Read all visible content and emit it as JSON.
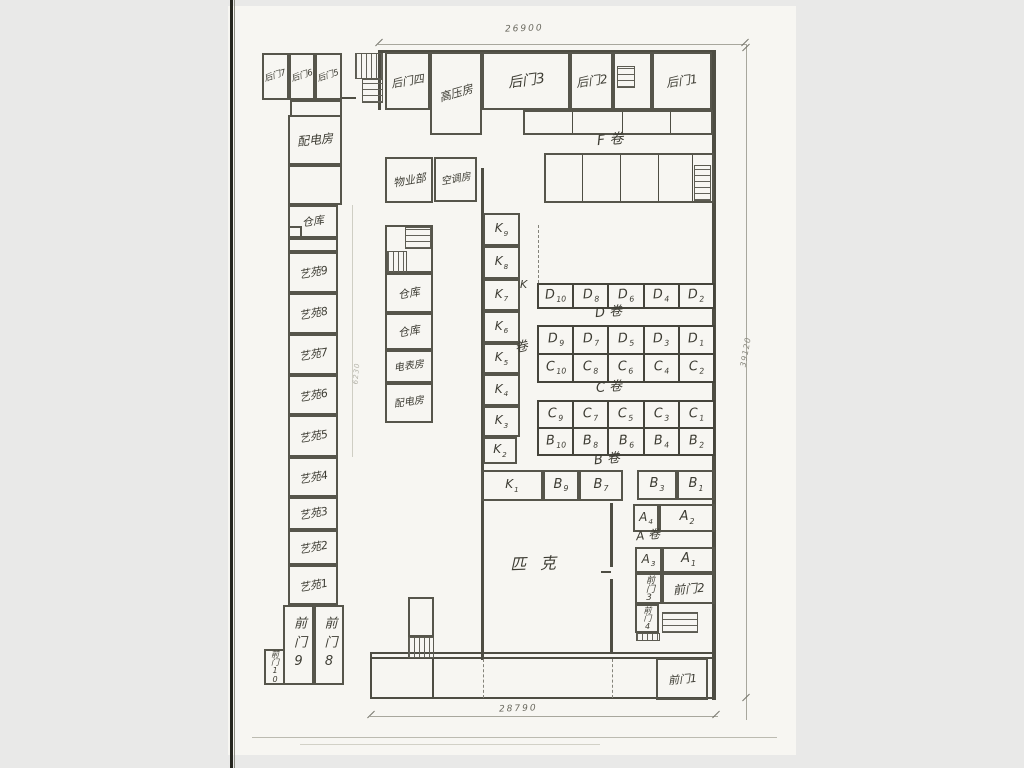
{
  "canvas": {
    "w": 1024,
    "h": 768,
    "bg": "#e9e9e8",
    "paper": "#f7f6f2",
    "ink": "#3d3c33",
    "wall": "#4e4d43"
  },
  "artifacts": [
    {
      "id": "paper-sheet",
      "x": 228,
      "y": 6,
      "w": 568,
      "h": 749,
      "c": "#f7f6f2"
    },
    {
      "id": "scan-edge-dark",
      "x": 230,
      "y": 0,
      "w": 3,
      "h": 768,
      "c": "#26261f"
    },
    {
      "id": "scan-edge-soft",
      "x": 234,
      "y": 0,
      "w": 1,
      "h": 768,
      "c": "#8a8a80"
    },
    {
      "id": "scan-bottom-line",
      "x": 252,
      "y": 737,
      "w": 525,
      "h": 1,
      "c": "#bcbbb1"
    },
    {
      "id": "scan-bottom-line-2",
      "x": 300,
      "y": 744,
      "w": 300,
      "h": 1,
      "c": "#d2d1c7"
    }
  ],
  "rooms": [
    {
      "id": "houmen-7",
      "t": "后门7",
      "x": 262,
      "y": 53,
      "w": 27,
      "h": 47,
      "fs": 8.5,
      "rot": -18
    },
    {
      "id": "houmen-6",
      "t": "后门6",
      "x": 289,
      "y": 53,
      "w": 26,
      "h": 47,
      "fs": 8.5,
      "rot": -18
    },
    {
      "id": "houmen-5",
      "t": "后门5",
      "x": 315,
      "y": 53,
      "w": 27,
      "h": 47,
      "fs": 8.5,
      "rot": -18
    },
    {
      "id": "annex-connector",
      "x": 290,
      "y": 100,
      "w": 52,
      "h": 17
    },
    {
      "id": "peidianfang-left",
      "t": "配电房",
      "x": 288,
      "y": 115,
      "w": 54,
      "h": 50,
      "fs": 12,
      "rot": -6
    },
    {
      "id": "left-empty-1",
      "x": 288,
      "y": 165,
      "w": 54,
      "h": 40
    },
    {
      "id": "cangku-left",
      "t": "仓库",
      "x": 288,
      "y": 205,
      "w": 50,
      "h": 33,
      "fs": 11,
      "rot": -8
    },
    {
      "id": "cangku-notch",
      "x": 288,
      "y": 226,
      "w": 14,
      "h": 12
    },
    {
      "id": "left-empty-2",
      "x": 288,
      "y": 238,
      "w": 50,
      "h": 14
    },
    {
      "id": "yiyuan-9",
      "t": "艺苑9",
      "x": 288,
      "y": 252,
      "w": 50,
      "h": 41,
      "fs": 11,
      "rot": -10
    },
    {
      "id": "yiyuan-8",
      "t": "艺苑8",
      "x": 288,
      "y": 293,
      "w": 50,
      "h": 41,
      "fs": 11,
      "rot": -10
    },
    {
      "id": "yiyuan-7",
      "t": "艺苑7",
      "x": 288,
      "y": 334,
      "w": 50,
      "h": 41,
      "fs": 11,
      "rot": -10
    },
    {
      "id": "yiyuan-6",
      "t": "艺苑6",
      "x": 288,
      "y": 375,
      "w": 50,
      "h": 40,
      "fs": 11,
      "rot": -10
    },
    {
      "id": "yiyuan-5",
      "t": "艺苑5",
      "x": 288,
      "y": 415,
      "w": 50,
      "h": 42,
      "fs": 11,
      "rot": -10
    },
    {
      "id": "yiyuan-4",
      "t": "艺苑4",
      "x": 288,
      "y": 457,
      "w": 50,
      "h": 40,
      "fs": 11,
      "rot": -10
    },
    {
      "id": "yiyuan-3",
      "t": "艺苑3",
      "x": 288,
      "y": 497,
      "w": 50,
      "h": 33,
      "fs": 11,
      "rot": -10
    },
    {
      "id": "yiyuan-2",
      "t": "艺苑2",
      "x": 288,
      "y": 530,
      "w": 50,
      "h": 35,
      "fs": 11,
      "rot": -10
    },
    {
      "id": "yiyuan-1",
      "t": "艺苑1",
      "x": 288,
      "y": 565,
      "w": 50,
      "h": 40,
      "fs": 11,
      "rot": -10
    },
    {
      "id": "qianmen-9",
      "t": "前门9",
      "x": 283,
      "y": 605,
      "w": 31,
      "h": 80,
      "fs": 13,
      "ls": 6,
      "vert": true
    },
    {
      "id": "qianmen-8",
      "t": "前门8",
      "x": 314,
      "y": 605,
      "w": 30,
      "h": 80,
      "fs": 13,
      "ls": 6,
      "vert": true
    },
    {
      "id": "qianmen-10",
      "t": "前门10",
      "x": 264,
      "y": 649,
      "w": 21,
      "h": 36,
      "fs": 8,
      "vert": true
    },
    {
      "id": "houmen-4",
      "t": "后门四",
      "x": 385,
      "y": 52,
      "w": 45,
      "h": 58,
      "fs": 11,
      "rot": -10
    },
    {
      "id": "gaoyafang",
      "t": "高压房",
      "x": 430,
      "y": 52,
      "w": 52,
      "h": 83,
      "fs": 11.5,
      "rot": -16
    },
    {
      "id": "houmen-3",
      "t": "后门3",
      "x": 482,
      "y": 52,
      "w": 88,
      "h": 58,
      "fs": 14,
      "rot": -8
    },
    {
      "id": "houmen-2",
      "t": "后门2",
      "x": 570,
      "y": 52,
      "w": 43,
      "h": 58,
      "fs": 12,
      "rot": -8
    },
    {
      "id": "top-stair-bay",
      "x": 613,
      "y": 52,
      "w": 39,
      "h": 58
    },
    {
      "id": "houmen-1",
      "t": "后门1",
      "x": 652,
      "y": 52,
      "w": 60,
      "h": 58,
      "fs": 12,
      "rot": -8
    },
    {
      "id": "north-strip",
      "x": 523,
      "y": 110,
      "w": 190,
      "h": 25
    },
    {
      "id": "f-stalls",
      "x": 544,
      "y": 153,
      "w": 170,
      "h": 50
    },
    {
      "id": "wuyebu",
      "t": "物业部",
      "x": 385,
      "y": 157,
      "w": 48,
      "h": 46,
      "fs": 11,
      "rot": -10
    },
    {
      "id": "kongtiaofang",
      "t": "空调房",
      "x": 434,
      "y": 157,
      "w": 43,
      "h": 45,
      "fs": 10,
      "rot": -10
    },
    {
      "id": "mid-stair-zone",
      "x": 385,
      "y": 225,
      "w": 48,
      "h": 48
    },
    {
      "id": "cangku-mid-1",
      "t": "仓库",
      "x": 385,
      "y": 273,
      "w": 48,
      "h": 40,
      "fs": 11,
      "rot": -10
    },
    {
      "id": "cangku-mid-2",
      "t": "仓库",
      "x": 385,
      "y": 313,
      "w": 48,
      "h": 37,
      "fs": 11,
      "rot": -10
    },
    {
      "id": "dianbiaofang",
      "t": "电表房",
      "x": 385,
      "y": 350,
      "w": 48,
      "h": 33,
      "fs": 10,
      "rot": -8
    },
    {
      "id": "peidianfang-mid",
      "t": "配电房",
      "x": 385,
      "y": 383,
      "w": 48,
      "h": 40,
      "fs": 10,
      "rot": -8
    },
    {
      "id": "k9",
      "t": "K",
      "s": "9",
      "x": 483,
      "y": 213,
      "w": 37,
      "h": 33,
      "fs": 12
    },
    {
      "id": "k8",
      "t": "K",
      "s": "8",
      "x": 483,
      "y": 246,
      "w": 37,
      "h": 33,
      "fs": 12
    },
    {
      "id": "k7",
      "t": "K",
      "s": "7",
      "x": 483,
      "y": 279,
      "w": 37,
      "h": 32,
      "fs": 12
    },
    {
      "id": "k6",
      "t": "K",
      "s": "6",
      "x": 483,
      "y": 311,
      "w": 37,
      "h": 32,
      "fs": 12
    },
    {
      "id": "k5",
      "t": "K",
      "s": "5",
      "x": 483,
      "y": 343,
      "w": 37,
      "h": 31,
      "fs": 12
    },
    {
      "id": "k4",
      "t": "K",
      "s": "4",
      "x": 483,
      "y": 374,
      "w": 37,
      "h": 32,
      "fs": 12
    },
    {
      "id": "k3",
      "t": "K",
      "s": "3",
      "x": 483,
      "y": 406,
      "w": 37,
      "h": 31,
      "fs": 12
    },
    {
      "id": "k2",
      "t": "K",
      "s": "2",
      "x": 483,
      "y": 437,
      "w": 34,
      "h": 27,
      "fs": 12
    },
    {
      "id": "k1",
      "t": "K",
      "s": "1",
      "x": 481,
      "y": 470,
      "w": 62,
      "h": 31,
      "fs": 12
    },
    {
      "id": "b9",
      "t": "B",
      "s": "9",
      "x": 543,
      "y": 470,
      "w": 36,
      "h": 31,
      "fs": 13
    },
    {
      "id": "b7",
      "t": "B",
      "s": "7",
      "x": 579,
      "y": 470,
      "w": 44,
      "h": 31,
      "fs": 13
    },
    {
      "id": "b3",
      "t": "B",
      "s": "3",
      "x": 637,
      "y": 470,
      "w": 40,
      "h": 30,
      "fs": 13
    },
    {
      "id": "b1",
      "t": "B",
      "s": "1",
      "x": 677,
      "y": 470,
      "w": 38,
      "h": 30,
      "fs": 13
    },
    {
      "id": "a4",
      "t": "A",
      "s": "4",
      "x": 633,
      "y": 504,
      "w": 26,
      "h": 28,
      "fs": 12
    },
    {
      "id": "a2",
      "t": "A",
      "s": "2",
      "x": 659,
      "y": 504,
      "w": 56,
      "h": 28,
      "fs": 13
    },
    {
      "id": "a3",
      "t": "A",
      "s": "3",
      "x": 635,
      "y": 547,
      "w": 27,
      "h": 26,
      "fs": 12
    },
    {
      "id": "a1",
      "t": "A",
      "s": "1",
      "x": 662,
      "y": 547,
      "w": 53,
      "h": 26,
      "fs": 13
    },
    {
      "id": "qianmen-3",
      "t": "前门3",
      "x": 635,
      "y": 573,
      "w": 27,
      "h": 31,
      "fs": 9,
      "vert": true
    },
    {
      "id": "qianmen-2",
      "t": "前门2",
      "x": 662,
      "y": 573,
      "w": 53,
      "h": 31,
      "fs": 12,
      "rot": -5
    },
    {
      "id": "qianmen-4",
      "t": "前门4",
      "x": 635,
      "y": 604,
      "w": 24,
      "h": 29,
      "fs": 8,
      "vert": true
    },
    {
      "id": "qianmen-1",
      "t": "前门1",
      "x": 656,
      "y": 658,
      "w": 52,
      "h": 42,
      "fs": 11,
      "rot": -5
    },
    {
      "id": "bl-stair-room",
      "x": 408,
      "y": 597,
      "w": 26,
      "h": 40
    }
  ],
  "grids": [
    {
      "id": "row-d-even",
      "x": 537,
      "y": 283,
      "w": 178,
      "h": 26,
      "fs": 13,
      "rows": [
        [
          [
            "D",
            "10"
          ],
          [
            "D",
            "8"
          ],
          [
            "D",
            "6"
          ],
          [
            "D",
            "4"
          ],
          [
            "D",
            "2"
          ]
        ]
      ]
    },
    {
      "id": "rows-d-odd-c-even",
      "x": 537,
      "y": 325,
      "w": 178,
      "h": 58,
      "fs": 13,
      "rows": [
        [
          [
            "D",
            "9"
          ],
          [
            "D",
            "7"
          ],
          [
            "D",
            "5"
          ],
          [
            "D",
            "3"
          ],
          [
            "D",
            "1"
          ]
        ],
        [
          [
            "C",
            "10"
          ],
          [
            "C",
            "8"
          ],
          [
            "C",
            "6"
          ],
          [
            "C",
            "4"
          ],
          [
            "C",
            "2"
          ]
        ]
      ]
    },
    {
      "id": "rows-c-odd-b-even",
      "x": 537,
      "y": 400,
      "w": 178,
      "h": 56,
      "fs": 13,
      "rows": [
        [
          [
            "C",
            "9"
          ],
          [
            "C",
            "7"
          ],
          [
            "C",
            "5"
          ],
          [
            "C",
            "3"
          ],
          [
            "C",
            "1"
          ]
        ],
        [
          [
            "B",
            "10"
          ],
          [
            "B",
            "8"
          ],
          [
            "B",
            "6"
          ],
          [
            "B",
            "4"
          ],
          [
            "B",
            "2"
          ]
        ]
      ]
    }
  ],
  "stairs": [
    {
      "id": "stair-topleft-upper",
      "x": 355,
      "y": 53,
      "w": 28,
      "h": 26,
      "dir": "v"
    },
    {
      "id": "stair-topleft-lower",
      "x": 362,
      "y": 79,
      "w": 21,
      "h": 24,
      "dir": "h"
    },
    {
      "id": "stair-top-bay",
      "x": 617,
      "y": 66,
      "w": 18,
      "h": 22,
      "dir": "h"
    },
    {
      "id": "stair-f-stalls",
      "x": 694,
      "y": 165,
      "w": 17,
      "h": 36,
      "dir": "h"
    },
    {
      "id": "stair-mid-upper",
      "x": 405,
      "y": 227,
      "w": 26,
      "h": 22,
      "dir": "h"
    },
    {
      "id": "stair-mid-lower",
      "x": 387,
      "y": 251,
      "w": 20,
      "h": 22,
      "dir": "v"
    },
    {
      "id": "stair-bottomleft",
      "x": 408,
      "y": 637,
      "w": 26,
      "h": 21,
      "dir": "v"
    },
    {
      "id": "stair-a-block",
      "x": 662,
      "y": 612,
      "w": 36,
      "h": 21,
      "dir": "h"
    },
    {
      "id": "hatch-a-block-small",
      "x": 636,
      "y": 633,
      "w": 24,
      "h": 8,
      "dir": "v"
    }
  ],
  "walls": [
    {
      "id": "wall-top",
      "x": 378,
      "y": 50,
      "w": 337,
      "h": 3
    },
    {
      "id": "wall-west-upper",
      "x": 378,
      "y": 50,
      "w": 3,
      "h": 60
    },
    {
      "id": "wall-right",
      "x": 712,
      "y": 50,
      "w": 4,
      "h": 650
    },
    {
      "id": "wall-inner-long",
      "x": 481,
      "y": 168,
      "w": 3,
      "h": 492
    },
    {
      "id": "wall-south",
      "x": 370,
      "y": 652,
      "w": 346,
      "h": 7,
      "double": true
    },
    {
      "id": "wall-arcade-bottom",
      "x": 370,
      "y": 697,
      "w": 346,
      "h": 2
    },
    {
      "id": "wall-arcade-left",
      "x": 370,
      "y": 652,
      "w": 2,
      "h": 47
    },
    {
      "id": "wall-arcade-div",
      "x": 432,
      "y": 658,
      "w": 2,
      "h": 40
    },
    {
      "id": "wall-pike-div-upper",
      "x": 610,
      "y": 503,
      "w": 3,
      "h": 64
    },
    {
      "id": "wall-pike-div-lower",
      "x": 610,
      "y": 579,
      "w": 3,
      "h": 74
    },
    {
      "id": "wall-pike-door-tick",
      "x": 601,
      "y": 571,
      "w": 10,
      "h": 2
    },
    {
      "id": "wall-strip-div-1",
      "x": 572,
      "y": 110,
      "w": 1,
      "h": 25
    },
    {
      "id": "wall-strip-div-2",
      "x": 622,
      "y": 110,
      "w": 1,
      "h": 25
    },
    {
      "id": "wall-strip-div-3",
      "x": 670,
      "y": 110,
      "w": 1,
      "h": 25
    },
    {
      "id": "wall-fstall-div-1",
      "x": 582,
      "y": 153,
      "w": 1,
      "h": 50
    },
    {
      "id": "wall-fstall-div-2",
      "x": 620,
      "y": 153,
      "w": 1,
      "h": 50
    },
    {
      "id": "wall-fstall-div-3",
      "x": 658,
      "y": 153,
      "w": 1,
      "h": 50
    },
    {
      "id": "wall-fstall-div-4",
      "x": 692,
      "y": 153,
      "w": 1,
      "h": 50
    },
    {
      "id": "wall-annex-link",
      "x": 342,
      "y": 97,
      "w": 14,
      "h": 2
    }
  ],
  "dashes": [
    {
      "id": "dash-hall-left",
      "x": 538,
      "y": 225,
      "h": 58
    },
    {
      "id": "dash-arcade-1",
      "x": 483,
      "y": 659,
      "h": 39
    },
    {
      "id": "dash-arcade-2",
      "x": 612,
      "y": 659,
      "h": 39
    }
  ],
  "dims": {
    "lines": [
      {
        "id": "dim-top-line",
        "x": 378,
        "y": 44,
        "w": 368,
        "h": 1
      },
      {
        "id": "dim-right-line",
        "x": 746,
        "y": 44,
        "w": 1,
        "h": 676
      },
      {
        "id": "dim-bottom-line",
        "x": 370,
        "y": 716,
        "w": 348,
        "h": 1
      },
      {
        "id": "dim-left-line",
        "x": 352,
        "y": 205,
        "w": 1,
        "h": 252,
        "c": "#cfcec4"
      }
    ],
    "ticks": [
      {
        "id": "tick-top-l",
        "x": 374,
        "y": 42
      },
      {
        "id": "tick-top-r",
        "x": 740,
        "y": 42
      },
      {
        "id": "tick-bottom-l",
        "x": 366,
        "y": 714
      },
      {
        "id": "tick-bottom-r",
        "x": 711,
        "y": 714
      },
      {
        "id": "tick-right-t",
        "x": 741,
        "y": 47
      },
      {
        "id": "tick-right-b",
        "x": 741,
        "y": 697
      }
    ]
  },
  "texts": [
    {
      "id": "dim-top-value",
      "t": "26900",
      "x": 505,
      "y": 25,
      "fs": 9,
      "rot": -2,
      "ls": 2,
      "c": "#6a695f"
    },
    {
      "id": "dim-right-value",
      "t": "39120",
      "x": 731,
      "y": 348,
      "fs": 8,
      "rot": -80,
      "ls": 1,
      "c": "#8a897f"
    },
    {
      "id": "dim-bottom-value",
      "t": "28790",
      "x": 499,
      "y": 705,
      "fs": 9,
      "rot": -2,
      "ls": 2,
      "c": "#6a695f"
    },
    {
      "id": "dim-left-value",
      "t": "6230",
      "x": 346,
      "y": 370,
      "fs": 7,
      "rot": -85,
      "ls": 1,
      "c": "#b3b2a8"
    },
    {
      "id": "section-f",
      "t": "F 卷",
      "x": 597,
      "y": 133,
      "fs": 14,
      "rot": -5,
      "c": "#3d3c33"
    },
    {
      "id": "section-d",
      "t": "D 卷",
      "x": 595,
      "y": 306,
      "fs": 13,
      "rot": -5,
      "c": "#3d3c33"
    },
    {
      "id": "section-c",
      "t": "C 卷",
      "x": 596,
      "y": 381,
      "fs": 13,
      "rot": -5,
      "c": "#3d3c33"
    },
    {
      "id": "section-b",
      "t": "B 卷",
      "x": 594,
      "y": 453,
      "fs": 13,
      "rot": -6,
      "c": "#3d3c33"
    },
    {
      "id": "section-a",
      "t": "A 卷",
      "x": 636,
      "y": 529,
      "fs": 12,
      "rot": -6,
      "c": "#3d3c33"
    },
    {
      "id": "section-k-letter",
      "t": "K",
      "x": 520,
      "y": 279,
      "fs": 11,
      "rot": 0,
      "c": "#3d3c33"
    },
    {
      "id": "section-k-juan",
      "t": "卷",
      "x": 515,
      "y": 341,
      "fs": 13,
      "rot": -12,
      "c": "#3d3c33"
    },
    {
      "id": "pike-hall",
      "t": "匹克",
      "x": 510,
      "y": 556,
      "fs": 16,
      "rot": -2,
      "ls": 14,
      "c": "#3d3c33"
    }
  ]
}
